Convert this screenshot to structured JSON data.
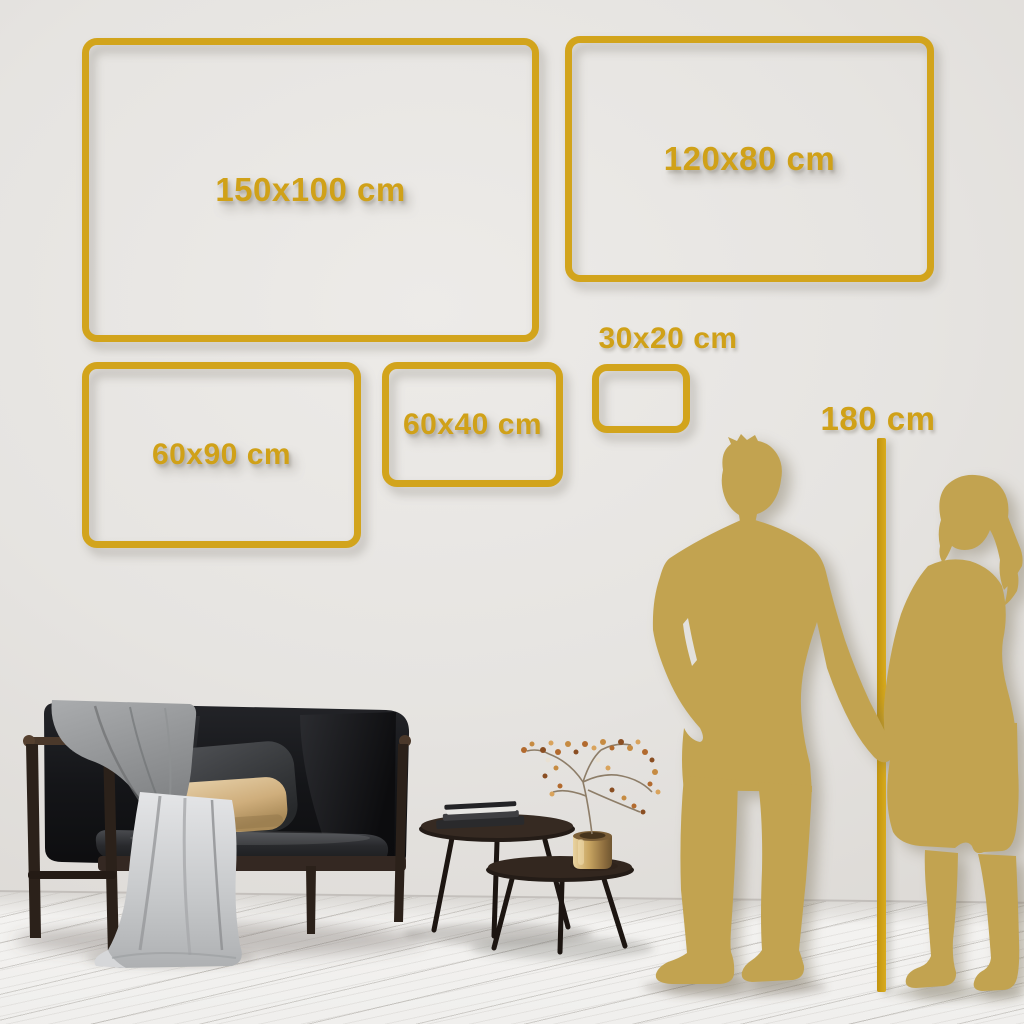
{
  "title": "Wall art size comparison guide",
  "unit": "cm",
  "frames": [
    {
      "id": "150x100",
      "label": "150x100 cm",
      "width_cm": 150,
      "height_cm": 100
    },
    {
      "id": "120x80",
      "label": "120x80 cm",
      "width_cm": 120,
      "height_cm": 80
    },
    {
      "id": "60x90",
      "label": "60x90 cm",
      "width_cm": 60,
      "height_cm": 90
    },
    {
      "id": "60x40",
      "label": "60x40 cm",
      "width_cm": 60,
      "height_cm": 40
    },
    {
      "id": "30x20",
      "label": "30x20 cm",
      "width_cm": 30,
      "height_cm": 20
    }
  ],
  "reference": {
    "height_label": "180 cm",
    "height_cm": 180
  },
  "colors": {
    "accent_gold": "#D2A41C",
    "silhouette_gold": "#C2A350",
    "wall": "#E5E3E0",
    "floor": "#F3F2F0",
    "pillow_beige": "#D6BC92",
    "sofa_black": "#161618"
  },
  "scene": {
    "items": [
      "sofa",
      "throw-blanket",
      "cushions",
      "nesting-coffee-tables",
      "books",
      "brass-vase-with-dried-branch",
      "man-silhouette",
      "woman-silhouette",
      "height-ruler"
    ]
  }
}
